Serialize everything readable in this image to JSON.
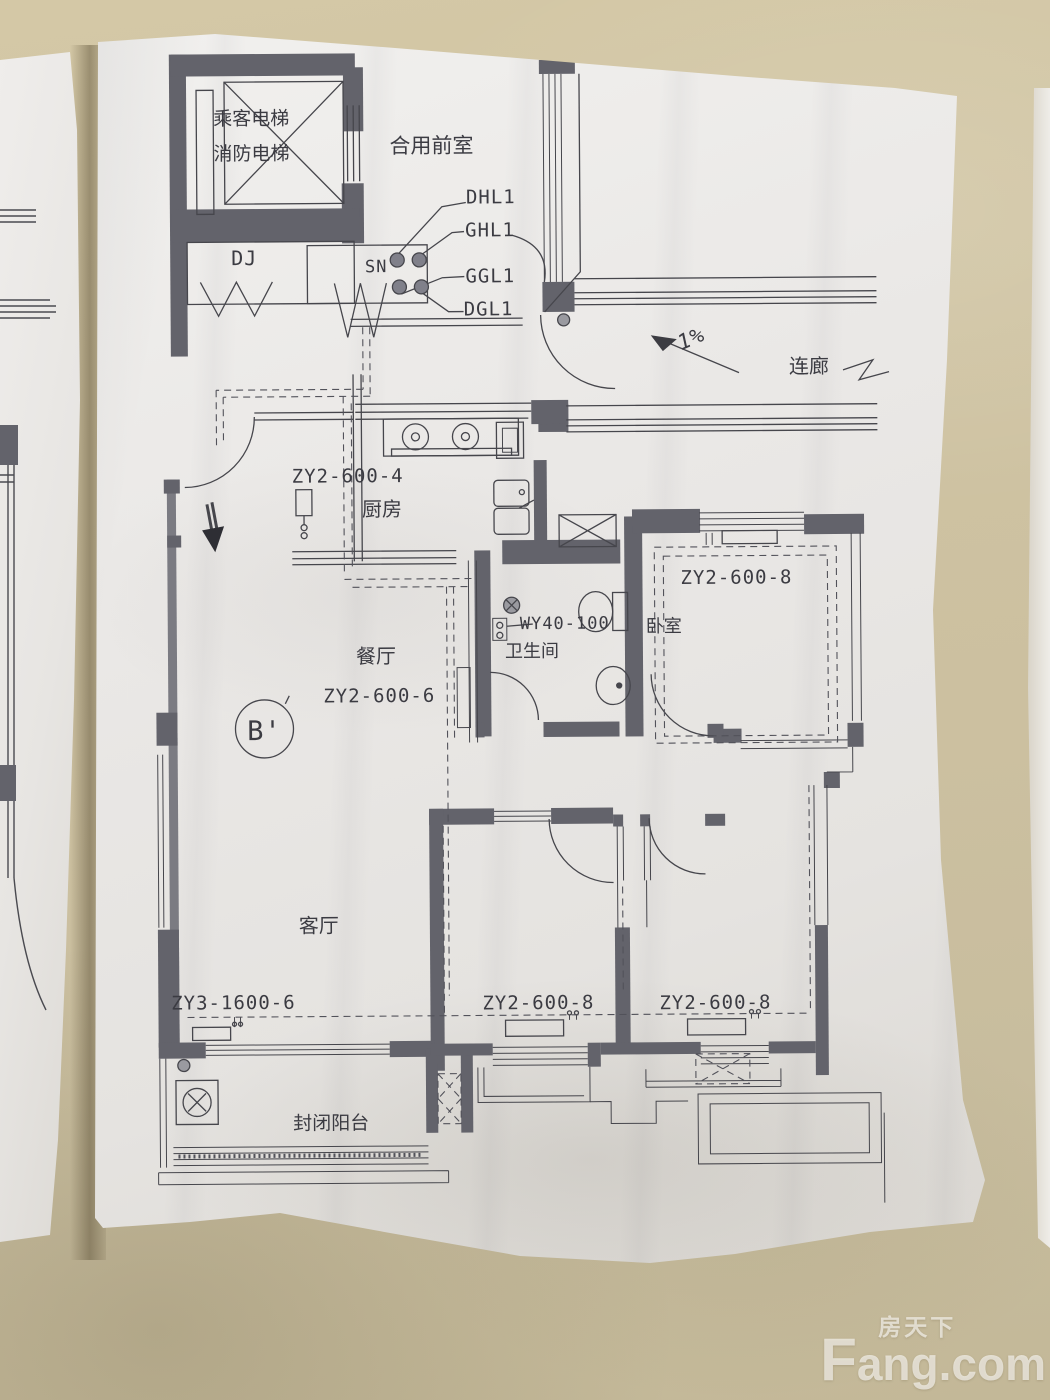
{
  "watermark": {
    "cn": "房天下",
    "latin": "Fang.com"
  },
  "floorplan": {
    "rooms": {
      "elevator_line1": "乘客电梯",
      "elevator_line2": "消防电梯",
      "shared_lobby": "合用前室",
      "dj": "DJ",
      "corridor": "连廊",
      "kitchen": "厨房",
      "bathroom": "卫生间",
      "bedroom": "卧室",
      "dining": "餐厅",
      "living": "客厅",
      "balcony": "封闭阳台"
    },
    "codes": {
      "riser": "SN",
      "dhl1": "DHL1",
      "ghl1": "GHL1",
      "ggl1": "GGL1",
      "dgl1": "DGL1",
      "slope": "1%",
      "kitchen": "ZY2-600-4",
      "bathroom": "WY40-100",
      "bedroom_top": "ZY2-600-8",
      "dining": "ZY2-600-6",
      "living": "ZY3-1600-6",
      "bedroom_left": "ZY2-600-8",
      "bedroom_right": "ZY2-600-8",
      "section_marker": "B'"
    }
  }
}
